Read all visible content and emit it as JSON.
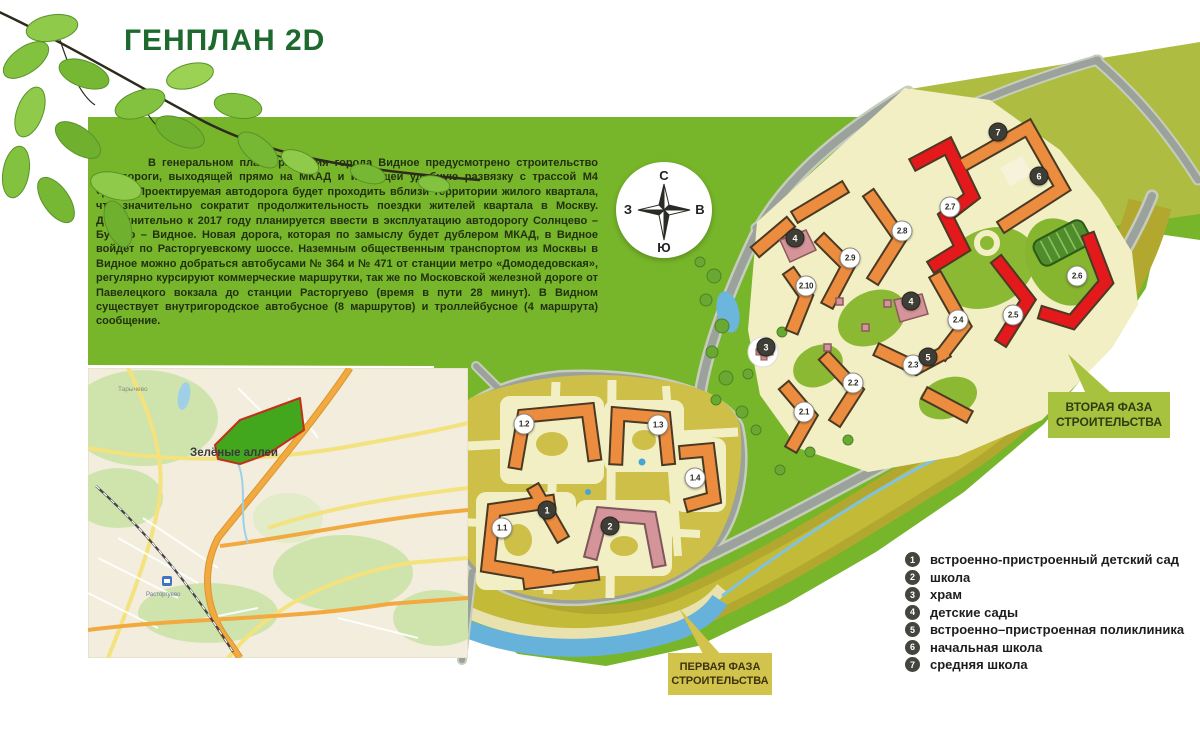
{
  "header": {
    "title": "ГЕНПЛАН 2D"
  },
  "intro": {
    "text": "В генеральном плане развития города Видное предусмотрено строительство автодороги, выходящей прямо на МКАД и имеющей удобную развязку с трассой М4 «Дон». Проектируемая автодорога будет проходить вблизи территории жилого квартала, что значительно сократит продолжительность поездки жителей квартала в Москву. Дополнительно к 2017 году планируется ввести в эксплуатацию автодорогу Солнцево – Бутово – Видное. Новая дорога, которая по замыслу будет дублером МКАД, в Видное войдет по Расторгуевскому шоссе. Наземным общественным транспортом из Москвы в Видное можно добраться автобусами № 364 и № 471 от станции метро «Домодедовская», регулярно курсируют коммерческие маршрутки, так же по Московской железной дороге от Павелецкого вокзала до станции Расторгуево (время в пути 28 минут). В Видном существует внутригородское автобусное (8 маршрутов) и троллейбусное (4 маршрута) сообщение."
  },
  "compass": {
    "north": "С",
    "south": "Ю",
    "west": "З",
    "east": "В"
  },
  "callouts": {
    "phase2": {
      "line1": "ВТОРАЯ ФАЗА",
      "line2": "СТРОИТЕЛЬСТВА"
    },
    "phase1": {
      "line1": "ПЕРВАЯ ФАЗА",
      "line2": "СТРОИТЕЛЬСТВА"
    }
  },
  "map_inset": {
    "labels": {
      "area": "Зелёные аллеи",
      "town": "Тарычево",
      "station": "Расторгуево"
    }
  },
  "legend": {
    "items": [
      {
        "num": "1",
        "label": "встроенно-пристроенный детский сад"
      },
      {
        "num": "2",
        "label": "школа"
      },
      {
        "num": "3",
        "label": "храм"
      },
      {
        "num": "4",
        "label": "детские сады"
      },
      {
        "num": "5",
        "label": "встроенно–пристроенная поликлиника"
      },
      {
        "num": "6",
        "label": "начальная школа"
      },
      {
        "num": "7",
        "label": "средняя школа"
      }
    ]
  },
  "plan_markers": [
    {
      "label": "1.1",
      "x": 502,
      "y": 528,
      "variant": "white"
    },
    {
      "label": "1.2",
      "x": 524,
      "y": 424,
      "variant": "white"
    },
    {
      "label": "1.3",
      "x": 658,
      "y": 425,
      "variant": "white"
    },
    {
      "label": "1.4",
      "x": 695,
      "y": 478,
      "variant": "white"
    },
    {
      "label": "2.1",
      "x": 804,
      "y": 412,
      "variant": "white"
    },
    {
      "label": "2.2",
      "x": 853,
      "y": 383,
      "variant": "white"
    },
    {
      "label": "2.3",
      "x": 913,
      "y": 365,
      "variant": "white"
    },
    {
      "label": "2.4",
      "x": 958,
      "y": 320,
      "variant": "white"
    },
    {
      "label": "2.5",
      "x": 1013,
      "y": 315,
      "variant": "white"
    },
    {
      "label": "2.6",
      "x": 1077,
      "y": 276,
      "variant": "white"
    },
    {
      "label": "2.7",
      "x": 950,
      "y": 207,
      "variant": "white"
    },
    {
      "label": "2.8",
      "x": 902,
      "y": 231,
      "variant": "white"
    },
    {
      "label": "2.9",
      "x": 850,
      "y": 258,
      "variant": "white"
    },
    {
      "label": "2.10",
      "x": 806,
      "y": 286,
      "variant": "white"
    },
    {
      "label": "1",
      "x": 547,
      "y": 510,
      "variant": "dark"
    },
    {
      "label": "2",
      "x": 610,
      "y": 526,
      "variant": "dark"
    },
    {
      "label": "3",
      "x": 766,
      "y": 347,
      "variant": "dark"
    },
    {
      "label": "4",
      "x": 795,
      "y": 238,
      "variant": "dark"
    },
    {
      "label": "4",
      "x": 911,
      "y": 301,
      "variant": "dark"
    },
    {
      "label": "5",
      "x": 928,
      "y": 357,
      "variant": "dark"
    },
    {
      "label": "6",
      "x": 1039,
      "y": 176,
      "variant": "dark"
    },
    {
      "label": "7",
      "x": 998,
      "y": 132,
      "variant": "dark"
    }
  ],
  "colors": {
    "accent_green": "#77b62a",
    "title_green": "#1e6a2e",
    "callout2_bg": "#a6c23f",
    "callout1_bg": "#d2c34c",
    "legend_circle": "#45453e",
    "marker_dark": "#3e3e37",
    "building_orange": "#ec8c3e",
    "building_red": "#e3191c",
    "building_pink": "#d59499"
  }
}
